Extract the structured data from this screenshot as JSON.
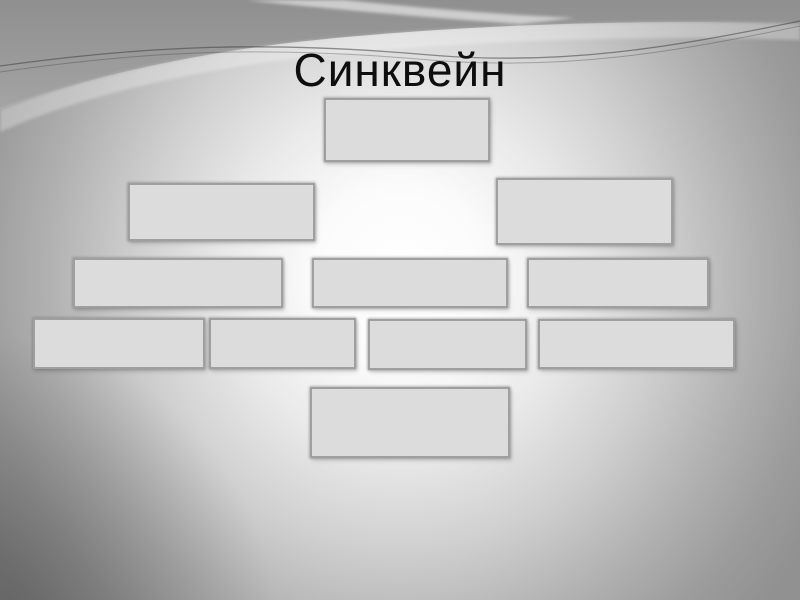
{
  "slide": {
    "title": "Синквейн",
    "theme": {
      "background_glow": "#ffffff",
      "background_edge_gray": "#919191",
      "background_dark_corner": "#686868",
      "box_fill": "#dcdcdc",
      "box_border": "#9f9f9f",
      "title_color": "#0e0e0e"
    },
    "diagram": {
      "description": "cinquain pyramid of empty placeholder boxes",
      "rows": [
        {
          "name": "row-1",
          "box_count": 1,
          "boxes": [
            "",
            ""
          ]
        },
        {
          "name": "row-2",
          "box_count": 2,
          "boxes": [
            "",
            ""
          ]
        },
        {
          "name": "row-3",
          "box_count": 3,
          "boxes": [
            "",
            "",
            ""
          ]
        },
        {
          "name": "row-4",
          "box_count": 4,
          "boxes": [
            "",
            "",
            "",
            ""
          ]
        },
        {
          "name": "row-5",
          "box_count": 1,
          "boxes": [
            ""
          ]
        }
      ]
    }
  }
}
